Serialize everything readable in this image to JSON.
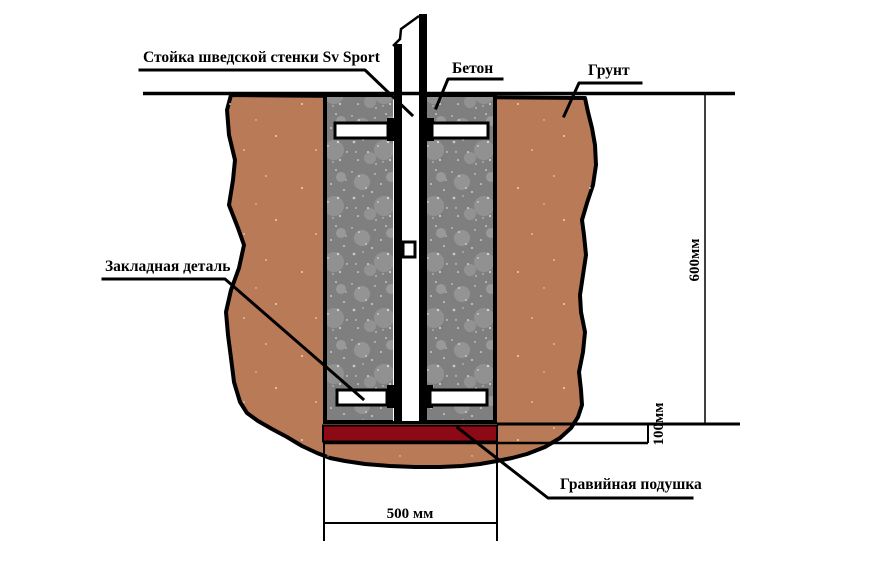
{
  "diagram": {
    "title_hint": "Installation cross-section of a Swedish wall post foundation",
    "labels": {
      "post": "Стойка шведской стенки Sv Sport",
      "concrete": "Бетон",
      "ground": "Грунт",
      "embedded": "Закладная деталь",
      "gravel": "Гравийная подушка"
    },
    "dimensions": {
      "depth": "600мм",
      "gravel_thickness": "100мм",
      "pit_width": "500 мм"
    },
    "colors": {
      "soil": "#b97a57",
      "concrete": "#7f7f7f",
      "speckle": "#ffffff",
      "gravel": "#8b0a15",
      "line": "#000000",
      "post_fill": "#ffffff"
    }
  }
}
